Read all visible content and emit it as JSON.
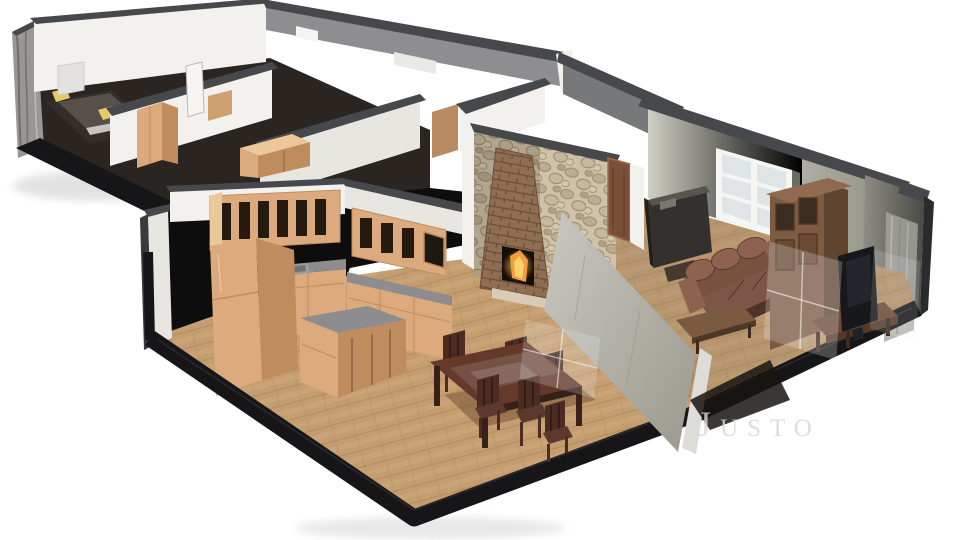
{
  "page": {
    "background": "#ffffff",
    "description": "Isometric 3D cutaway floor-plan rendering of an apartment with two bedrooms, hallway, kitchen, dining area and living room"
  },
  "watermark": {
    "text": "Justo"
  },
  "palette": {
    "bg": "#ffffff",
    "capDark": "#47484b",
    "capMid": "#6e6f72",
    "wallWhite": "#f2f1ed",
    "wallIvory": "#e7e6e1",
    "wallGray": "#8e8e90",
    "wallGrayDark": "#77787a",
    "wallGreen": "#b2b2a8",
    "wallGreenLight": "#d6d6cc",
    "texWall": "#989794",
    "texStreak": "#5f5e5c",
    "voidBlack": "#0e0d0d",
    "platform": "#161618",
    "floorWood": "#c59e70",
    "floorSeam": "#a8845a",
    "floorLight": "#d8b486",
    "cabWood": "#dcaa7c",
    "cabWoodDark": "#bf8c5e",
    "cabWoodLight": "#ecc79a",
    "counter": "#8d8d8f",
    "slat": "#241a10",
    "stone": "#cfc2a8",
    "stoneShade": "#9a8a70",
    "brick": "#906e52",
    "brickSeam": "#6b4d38",
    "fire": "#f59d3c",
    "fireCore": "#fcd26a",
    "diningWood": "#4c2c22",
    "diningTop": "#64392c",
    "sofa": "#77523f",
    "sofaLight": "#8d6350",
    "sofaDark": "#4f332a",
    "piano": "#34302d",
    "hutch": "#7d5a42",
    "hutchDark": "#5f4430",
    "tv": "#17181c",
    "stand": "#6b4a36",
    "pillow": "#e8c967",
    "bedFrame": "#332e2a",
    "glass": "#eef2f4",
    "curtain": "#a6a6a0",
    "watermark": "#d6d6d4"
  },
  "scene": {
    "type": "3d-floorplan-render",
    "rooms": [
      {
        "name": "bedroom-1",
        "objects": [
          "bed",
          "yellow-pillows",
          "wall-picture",
          "wardrobe"
        ]
      },
      {
        "name": "bedroom-2",
        "objects": [
          "dresser",
          "cabinet"
        ]
      },
      {
        "name": "hallway-bath",
        "objects": [
          "interior-walls",
          "door-leaf"
        ]
      },
      {
        "name": "kitchen",
        "objects": [
          "upper-cabinets",
          "base-cabinets",
          "counter",
          "sink",
          "refrigerator",
          "island"
        ]
      },
      {
        "name": "dining-area",
        "objects": [
          "dining-table",
          "six-chairs",
          "wood-floor"
        ]
      },
      {
        "name": "living-room",
        "objects": [
          "stone-fireplace-wall",
          "fireplace-fire",
          "interior-door",
          "piano",
          "sofa",
          "coffee-table",
          "hutch-cabinet",
          "tv",
          "tv-stand",
          "window",
          "curtain",
          "glass-reflections"
        ]
      }
    ]
  }
}
